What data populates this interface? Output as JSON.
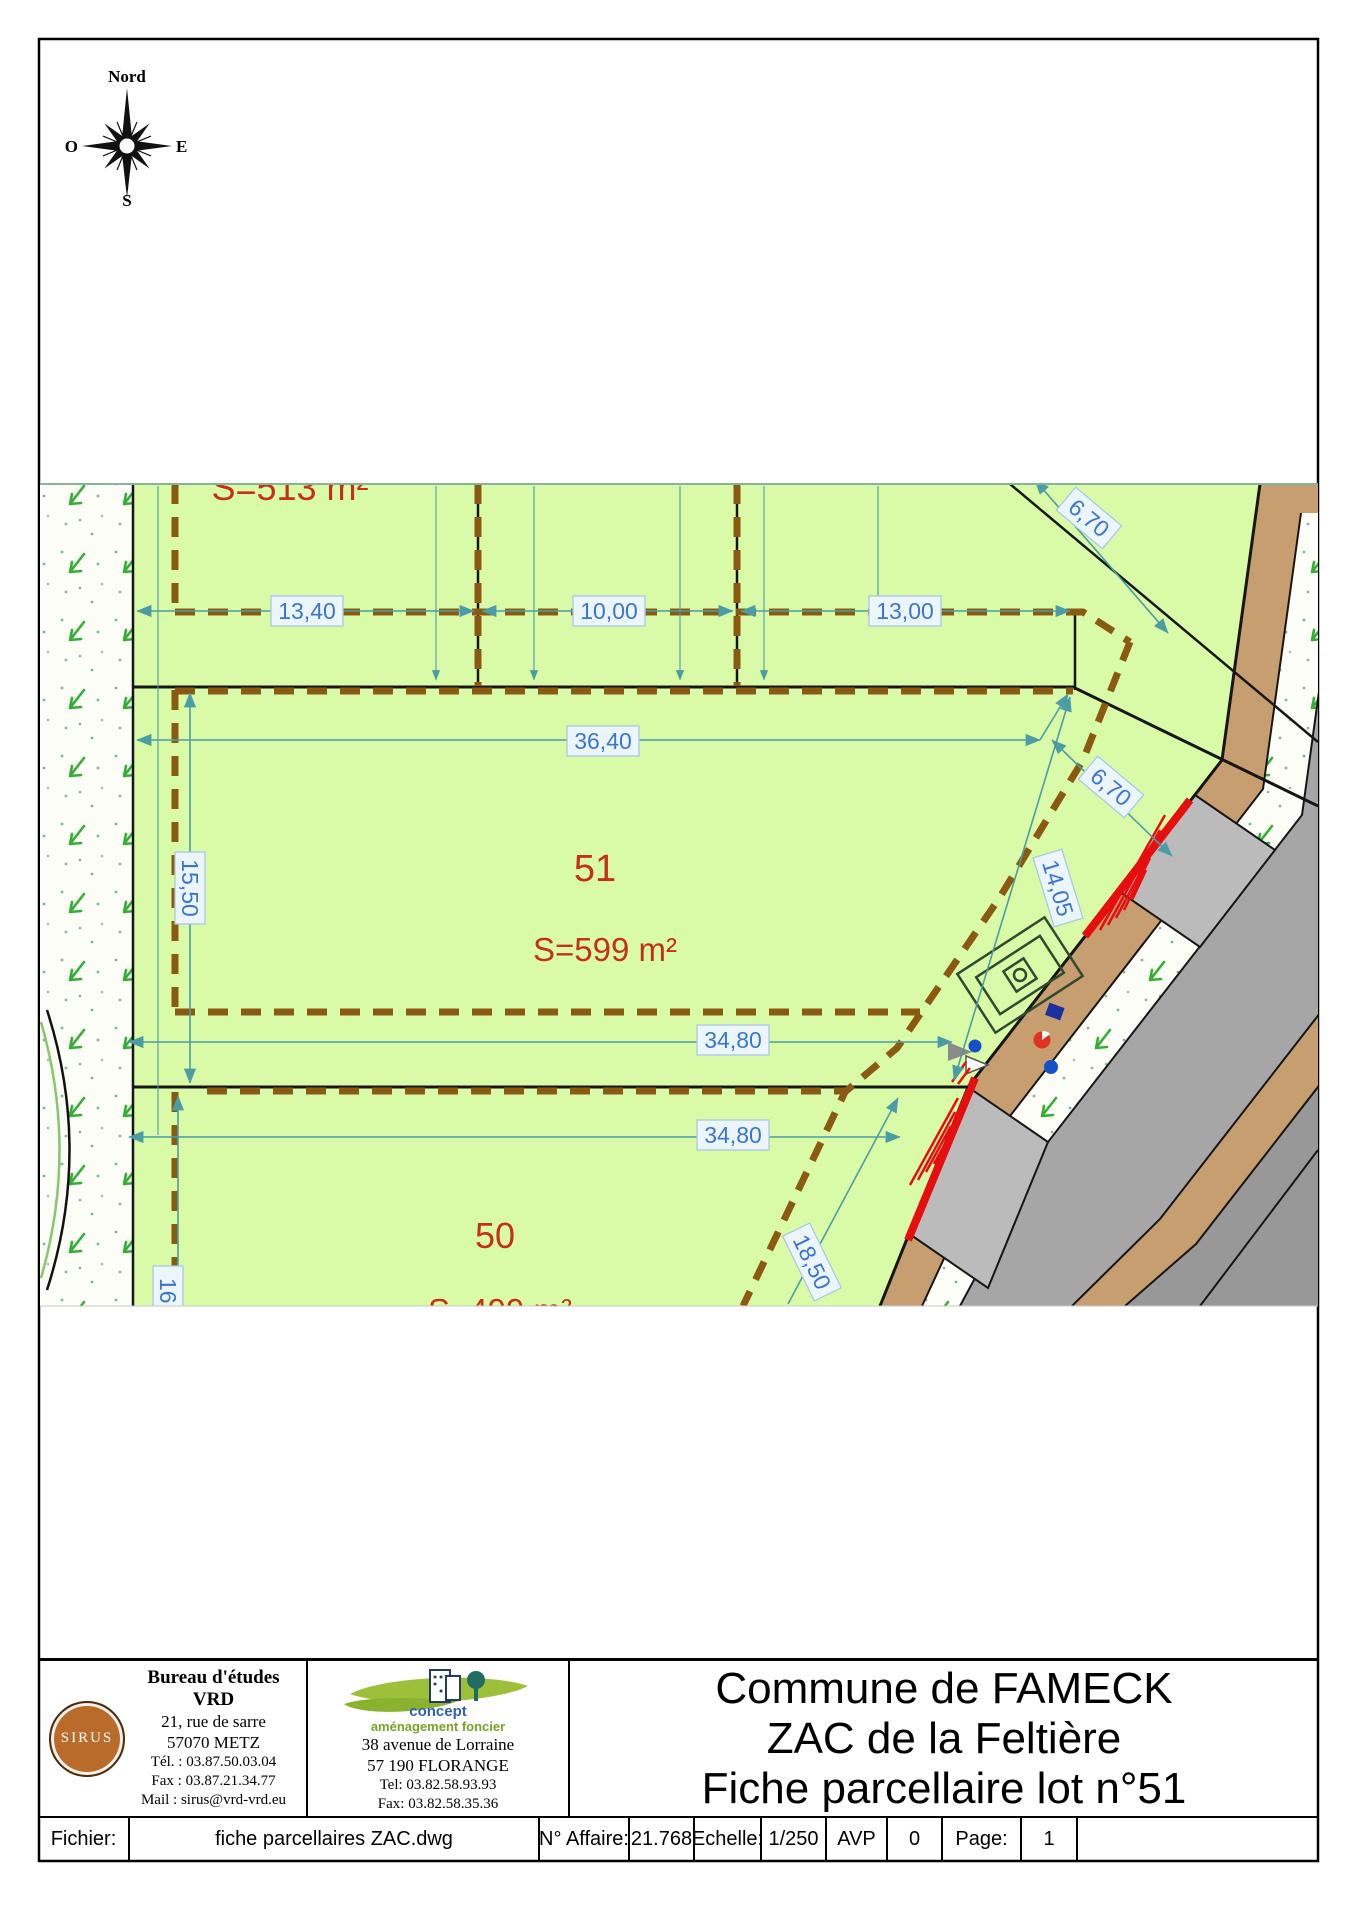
{
  "compass": {
    "north": "Nord",
    "south": "S",
    "east": "E",
    "west": "O"
  },
  "plan": {
    "lots": {
      "lot51_no": "51",
      "lot51_area": "S=599 m²",
      "lot50_no": "50",
      "lot50_area": "S=499 m²",
      "top_area": "S=513 m²"
    },
    "dims": {
      "dim_13_40": "13,40",
      "dim_10_00": "10,00",
      "dim_13_00": "13,00",
      "dim_36_40": "36,40",
      "dim_15_50": "15,50",
      "dim_6_70": "6,70",
      "dim_14_05": "14,05",
      "dim_34_80": "34,80",
      "dim_18_50": "18,50",
      "dim_16": "16,"
    }
  },
  "title_block": {
    "sirus_logo": "SIRUS",
    "bureau": {
      "name": "Bureau d'études VRD",
      "address1": "21, rue de sarre",
      "address2": "57070 METZ",
      "tel": "Tél. : 03.87.50.03.04",
      "fax": "Fax : 03.87.21.34.77",
      "mail": "Mail : sirus@vrd-vrd.eu"
    },
    "concept": {
      "brand1": "concept",
      "brand2": "aménagement foncier",
      "address1": "38 avenue de Lorraine",
      "address2": "57 190 FLORANGE",
      "tel": "Tel: 03.82.58.93.93",
      "fax": "Fax: 03.82.58.35.36"
    },
    "titles": {
      "line1": "Commune de FAMECK",
      "line2": "ZAC de la Feltière",
      "line3": "Fiche parcellaire lot n°51"
    }
  },
  "footer": {
    "file_label": "Fichier:",
    "file_value": "fiche parcellaires ZAC.dwg",
    "affaire_label": "N° Affaire:",
    "affaire_value": "21.768",
    "scale_label": "Echelle:",
    "scale_value": "1/250",
    "phase": "AVP",
    "index": "0",
    "page_label": "Page:",
    "page_value": "1"
  },
  "colors": {
    "parcel_green": "#d9fba8",
    "boundary_brown": "#8a5a10",
    "dimension_teal": "#4a9da5",
    "dimension_text_blue": "#3a76cc",
    "lot_label_red": "#c5301a",
    "sidewalk_tan": "#c79e6f",
    "road_gray": "#a6a6a6",
    "curb_red": "#e60e0e"
  }
}
